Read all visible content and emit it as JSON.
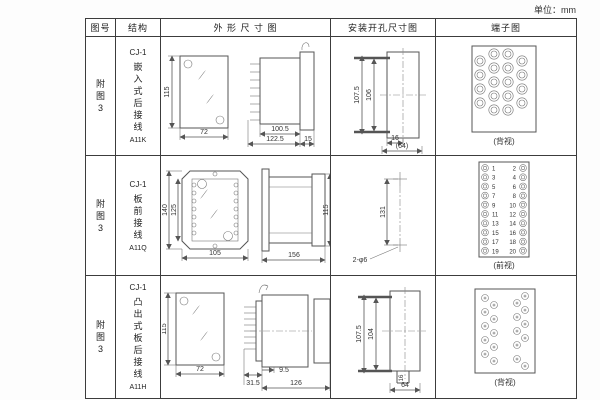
{
  "unit_label": "单位：mm",
  "table": {
    "headers": {
      "figure": "图号",
      "structure": "结构",
      "outline": "外 形 尺 寸 图",
      "mounting": "安装开孔尺寸图",
      "terminal": "端子图"
    }
  },
  "rows": [
    {
      "figure": "附图3",
      "model": "CJ-1",
      "desc": "嵌入式后接线",
      "code": "A11K",
      "outline": {
        "front_h": "115",
        "front_w": "72",
        "side_l1": "100.5",
        "side_l2": "122.5",
        "side_l3": "15"
      },
      "mounting": {
        "outer_h": "107.5",
        "inner_h": "106",
        "slot_w": "16",
        "total_w": "(64)"
      },
      "terminal": {
        "view": "(背视)"
      }
    },
    {
      "figure": "附图3",
      "model": "CJ-1",
      "desc": "板前接线",
      "code": "A11Q",
      "outline": {
        "front_h": "140",
        "front_h2": "125",
        "front_w": "105",
        "side_l": "156",
        "side_h": "115"
      },
      "mounting": {
        "hole_dist": "131",
        "hole_note": "2-φ6"
      },
      "terminal": {
        "view": "(前视)",
        "left_nums": [
          "1",
          "3",
          "5",
          "7",
          "9",
          "11",
          "13",
          "15",
          "17",
          "19"
        ],
        "right_nums": [
          "2",
          "4",
          "6",
          "8",
          "10",
          "12",
          "14",
          "16",
          "18",
          "20"
        ]
      }
    },
    {
      "figure": "附图3",
      "model": "CJ-1",
      "desc": "凸出式板后接线",
      "code": "A11H",
      "outline": {
        "front_h": "115",
        "front_w": "72",
        "side_l1": "31.5",
        "side_l2": "9.5",
        "side_l3": "126"
      },
      "mounting": {
        "outer_h": "107.5",
        "inner_h": "104",
        "slot_w": "16",
        "total_w": "64"
      },
      "terminal": {
        "view": "(背视)"
      }
    }
  ]
}
